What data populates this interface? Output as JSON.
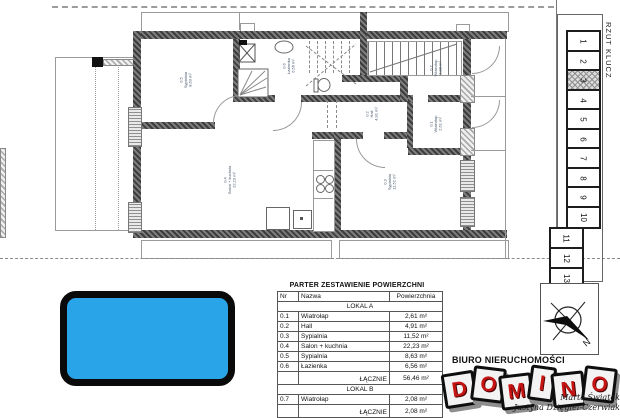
{
  "legend": {
    "title": "RZUT KLUCZ",
    "items": [
      "1",
      "2",
      "3",
      "4",
      "5",
      "6",
      "7",
      "8",
      "9",
      "10",
      "11",
      "12",
      "13"
    ],
    "highlighted_item": "3"
  },
  "table": {
    "title": "PARTER ZESTAWIENIE POWIERZCHNI",
    "columns": [
      "Nr",
      "Nazwa",
      "Powierzchnia"
    ],
    "section_a": "LOKAL A",
    "rows_a": [
      {
        "nr": "0.1",
        "name": "Wiatrołap",
        "area": "2,61 m²"
      },
      {
        "nr": "0.2",
        "name": "Hall",
        "area": "4,91 m²"
      },
      {
        "nr": "0.3",
        "name": "Sypialnia",
        "area": "11,52 m²"
      },
      {
        "nr": "0.4",
        "name": "Salon + kuchnia",
        "area": "22,23 m²"
      },
      {
        "nr": "0.5",
        "name": "Sypialnia",
        "area": "8,63 m²"
      },
      {
        "nr": "0.6",
        "name": "Łazienka",
        "area": "6,56 m²"
      }
    ],
    "total_a_label": "ŁĄCZNIE",
    "total_a_area": "56,46 m²",
    "section_b": "LOKAL B",
    "rows_b": [
      {
        "nr": "0.7",
        "name": "Wiatrołap",
        "area": "2,08 m²"
      }
    ],
    "total_b_label": "ŁĄCZNIE",
    "total_b_area": "2,08 m²",
    "grand_label": "PARTER ŁĄCZNIE",
    "grand_area": "58,54 m²"
  },
  "plan": {
    "rooms": [
      {
        "id": "0.5",
        "name": "Sypialnia",
        "area": "8,63 m²"
      },
      {
        "id": "0.6",
        "name": "Łazienka",
        "area": "6,56 m²"
      },
      {
        "id": "0.2",
        "name": "Hall",
        "area": "4,91 m²"
      },
      {
        "id": "0.1",
        "name": "Wiatrołap",
        "area": "2,61 m²"
      },
      {
        "id": "0.7",
        "name": "Wiatrołap",
        "area": "2,08 m²"
      },
      {
        "id": "0.4",
        "name": "Salon + kuchnia",
        "area": "22,23 m²"
      },
      {
        "id": "0.3",
        "name": "Sypialnia",
        "area": "11,52 m²"
      }
    ]
  },
  "compass": {
    "north_label": "N"
  },
  "branding": {
    "office": "BIURO NIERUCHOMOŚCI",
    "logo_letters": [
      "D",
      "O",
      "M",
      "I",
      "N",
      "O"
    ],
    "signature1": "Marta Świątek",
    "signature2": "Justyna Dzięgiel-Czerwiak"
  },
  "colors": {
    "blue_box": "#29a4e9",
    "logo_red": "#c41414",
    "wall_dark": "#3d3d3d"
  }
}
